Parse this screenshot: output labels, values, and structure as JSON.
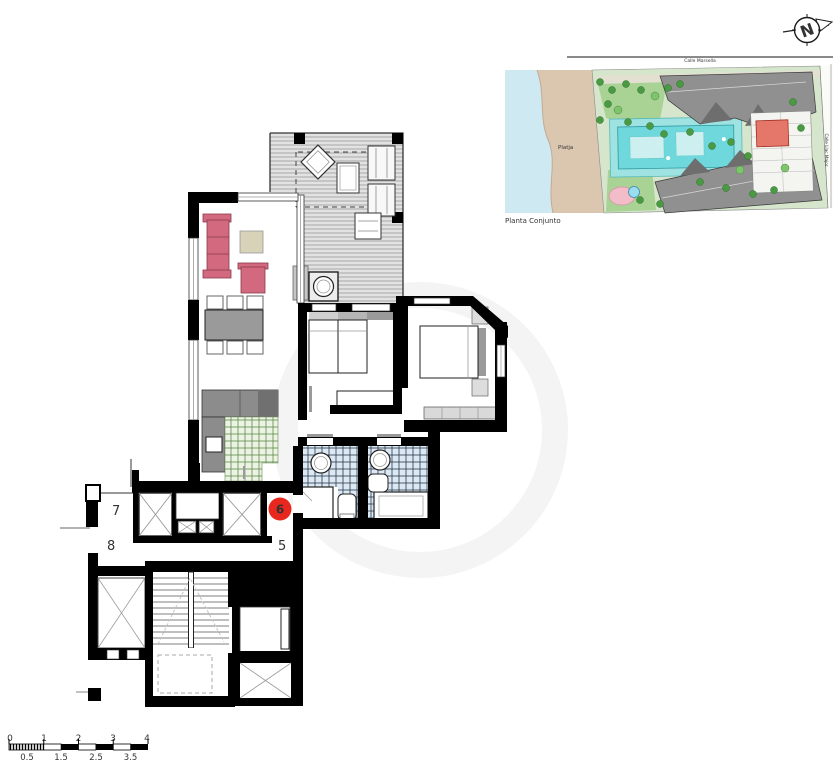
{
  "north_arrow": {
    "letter": "N"
  },
  "site_plan": {
    "caption": "Planta Conjunto",
    "street_top": "Calle Marsella",
    "street_right": "Calle Llac Major",
    "beach_label": "Platja"
  },
  "floor_plan": {
    "landing_units": {
      "unit_7": "7",
      "unit_8": "8",
      "unit_5": "5"
    },
    "marker": {
      "unit": "6"
    }
  },
  "scale_bar": {
    "top_labels": [
      "0",
      "1",
      "2",
      "3",
      "4"
    ],
    "bottom_labels": [
      "0.5",
      "1.5",
      "2.5",
      "3.5"
    ]
  },
  "colors": {
    "marker_red": "#e8281e",
    "marker_digit": "#8b1713",
    "sofa_pink": "#d2697e",
    "kitchen_tile_green": "#5d8a48",
    "bath_tile_line": "#2a3a4a",
    "bath_tile_fill": "#dce9f5",
    "deck_line_gray": "#a8a8a8",
    "pool_teal": "#6fd8dc",
    "sand": "#dbc7b0",
    "sea": "#cfe9f3",
    "roof_gray": "#909090",
    "grass": "#a9d295",
    "highlight_unit_red": "#e4766a"
  }
}
